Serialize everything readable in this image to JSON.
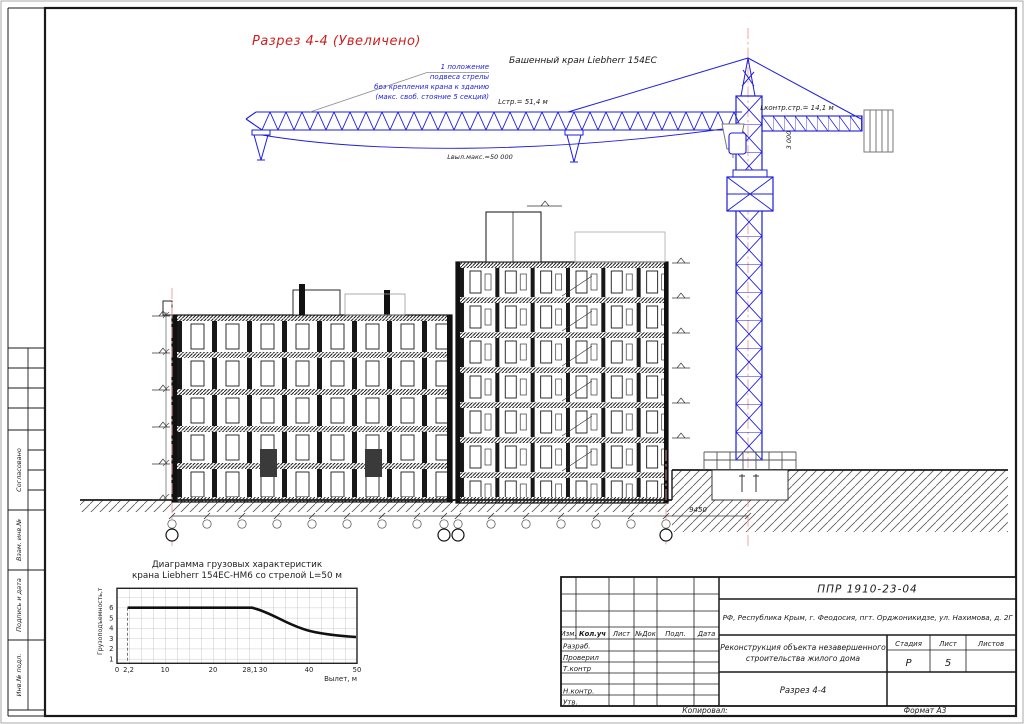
{
  "sheet": {
    "footer": {
      "kopiroval": "Копировал:",
      "format": "Формат А3"
    }
  },
  "sidebar": {
    "soglasovano": "Согласовано",
    "vzam_inv": "Взам. инв.№",
    "podpis_data": "Подпись и дата",
    "inv_podl": "Инв.№ подл."
  },
  "drawing": {
    "section_title": "Разрез 4-4 (Увеличено)",
    "crane_name": "Башенный кран Liebherr 154EC",
    "annotation": [
      "1 положение",
      "подвеса стрелы",
      "без крепления крана к зданию",
      "(макс. своб. стояние 5 секций)"
    ],
    "jib_length": "Lстр.= 51,4 м",
    "max_outreach": "Lвыл.макс.=50 000",
    "counterjib_length": "Lконтр.стр.= 14,1 м",
    "tower_top_dim": "3 000",
    "crane_offset_dim": "9450"
  },
  "chart_data": {
    "type": "line",
    "title": "Диаграмма грузовых характеристик крана Liebherr 154EC-HM6 со стрелой L=50 м",
    "title_lines": [
      "Диаграмма грузовых характеристик",
      "крана Liebherr 154EC-HM6 со стрелой L=50 м"
    ],
    "xlabel": "Вылет, м",
    "ylabel": "Грузоподъемность,т",
    "x_ticks": [
      "0",
      "2,2",
      "10",
      "20",
      "28,1",
      "30",
      "40",
      "50"
    ],
    "y_ticks": [
      "1",
      "2",
      "3",
      "4",
      "5",
      "6"
    ],
    "xlim": [
      0,
      50
    ],
    "ylim": [
      0,
      7.3
    ],
    "grid": true,
    "legend": "none",
    "series": [
      {
        "name": "Грузоподъемность крана, т",
        "points": [
          [
            2.2,
            6
          ],
          [
            28.1,
            6
          ],
          [
            30,
            5.6
          ],
          [
            35,
            4.9
          ],
          [
            40,
            4.2
          ],
          [
            45,
            3.7
          ],
          [
            50,
            3.25
          ]
        ]
      }
    ]
  },
  "title_block": {
    "doc_number": "ППР 1910-23-04",
    "location": "РФ, Республика Крым, г. Феодосия, пгт. Орджоникидзе, ул. Нахимова, д. 2Г",
    "project_lines": [
      "Реконструкция объекта незавершенного",
      "строительства жилого дома"
    ],
    "sheet_name": "Разрез 4-4",
    "columns": {
      "izm": "Изм.",
      "koluch": "Кол.уч",
      "list": "Лист",
      "dok": "№Док",
      "podp": "Подп.",
      "data": "Дата"
    },
    "rows": {
      "razrab": "Разраб.",
      "proveril": "Проверил",
      "tkontr": "Т.контр",
      "nkontr": "Н.контр.",
      "utv": "Утв."
    },
    "stage": {
      "label": "Стадия",
      "value": "Р"
    },
    "sheet": {
      "label": "Лист",
      "value": "5"
    },
    "sheets": {
      "label": "Листов",
      "value": ""
    }
  }
}
